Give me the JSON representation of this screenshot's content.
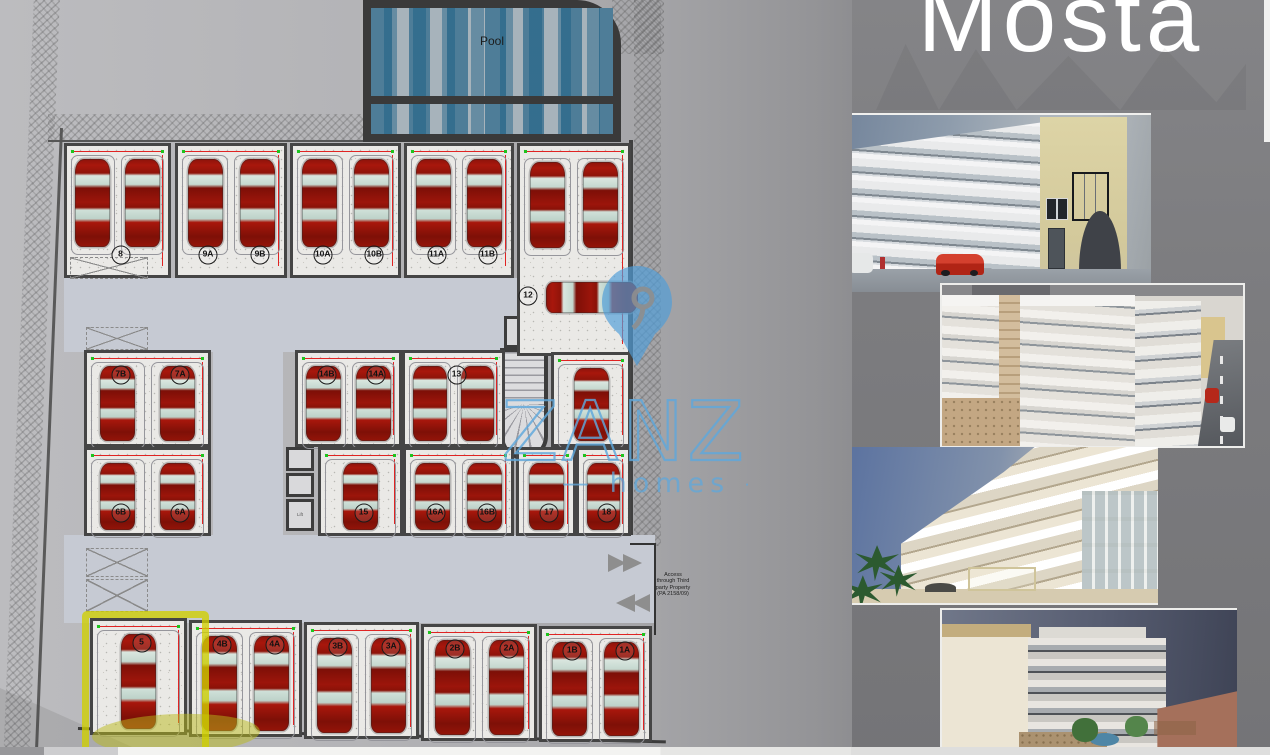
{
  "project": {
    "title": "Mosta"
  },
  "watermark": {
    "brand": "ZANZI",
    "tagline": "— homes —",
    "pin_color": "#4f9dd9",
    "text_color": "#5fa8dc"
  },
  "floor_plan": {
    "pool_label": "Pool",
    "lift_label": "Lift",
    "access_note": "Access through Third party Property (PA 2158/09)",
    "colors": {
      "driveway": "#c6cad3",
      "bay_floor": "#eae9e6",
      "wall": "#454545",
      "car_body": "#9c150b",
      "car_glass": "#cfe0d8",
      "dimension_line": "#e02322",
      "dimension_tick": "#1ec41e",
      "highlight": "#d0d000"
    },
    "bays": [
      {
        "x": 64,
        "y": 143,
        "w": 107,
        "h": 135,
        "cars": 2,
        "labels": [
          "8"
        ],
        "labelAt": "bottom"
      },
      {
        "x": 175,
        "y": 143,
        "w": 112,
        "h": 135,
        "cars": 2,
        "labels": [
          "9A",
          "9B"
        ],
        "labelAt": "bottom"
      },
      {
        "x": 290,
        "y": 143,
        "w": 111,
        "h": 135,
        "cars": 2,
        "labels": [
          "10A",
          "10B"
        ],
        "labelAt": "bottom"
      },
      {
        "x": 404,
        "y": 143,
        "w": 110,
        "h": 135,
        "cars": 2,
        "labels": [
          "11A",
          "11B"
        ],
        "labelAt": "bottom"
      },
      {
        "x": 517,
        "y": 143,
        "w": 114,
        "h": 213,
        "cars": 2,
        "labels": [],
        "labelAt": "bottom",
        "carH": 86,
        "carTop": 16
      },
      {
        "x": 84,
        "y": 350,
        "w": 127,
        "h": 97,
        "cars": 2,
        "labels": [
          "7B",
          "7A"
        ],
        "labelAt": "top"
      },
      {
        "x": 295,
        "y": 350,
        "w": 107,
        "h": 97,
        "cars": 2,
        "labels": [
          "14B",
          "14A"
        ],
        "labelAt": "top"
      },
      {
        "x": 402,
        "y": 350,
        "w": 103,
        "h": 97,
        "cars": 2,
        "labels": [
          "13"
        ],
        "labelAt": "top"
      },
      {
        "x": 551,
        "y": 352,
        "w": 80,
        "h": 95,
        "cars": 1,
        "labels": [],
        "labelAt": "top"
      },
      {
        "x": 84,
        "y": 447,
        "w": 127,
        "h": 89,
        "cars": 2,
        "labels": [
          "6B",
          "6A"
        ],
        "labelAt": "bottom"
      },
      {
        "x": 318,
        "y": 447,
        "w": 85,
        "h": 89,
        "cars": 1,
        "labels": [
          "15"
        ],
        "labelAt": "bottom"
      },
      {
        "x": 403,
        "y": 447,
        "w": 111,
        "h": 89,
        "cars": 2,
        "labels": [
          "16A",
          "16B"
        ],
        "labelAt": "bottom"
      },
      {
        "x": 516,
        "y": 447,
        "w": 60,
        "h": 89,
        "cars": 1,
        "labels": [
          "17"
        ],
        "labelAt": "bottom"
      },
      {
        "x": 576,
        "y": 447,
        "w": 55,
        "h": 89,
        "cars": 1,
        "labels": [
          "18"
        ],
        "labelAt": "bottom"
      },
      {
        "x": 90,
        "y": 618,
        "w": 97,
        "h": 117,
        "cars": 1,
        "labels": [
          "5"
        ],
        "labelAt": "top",
        "highlight": true
      },
      {
        "x": 189,
        "y": 620,
        "w": 113,
        "h": 117,
        "cars": 2,
        "labels": [
          "4B",
          "4A"
        ],
        "labelAt": "top"
      },
      {
        "x": 304,
        "y": 622,
        "w": 115,
        "h": 117,
        "cars": 2,
        "labels": [
          "3B",
          "3A"
        ],
        "labelAt": "top"
      },
      {
        "x": 421,
        "y": 624,
        "w": 116,
        "h": 117,
        "cars": 2,
        "labels": [
          "2B",
          "2A"
        ],
        "labelAt": "top"
      },
      {
        "x": 539,
        "y": 626,
        "w": 113,
        "h": 116,
        "cars": 2,
        "labels": [
          "1B",
          "1A"
        ],
        "labelAt": "top"
      }
    ],
    "extra_cars": [
      {
        "x": 546,
        "y": 282,
        "w": 92,
        "h": 31
      }
    ],
    "extra_labels": [
      {
        "text": "12",
        "x": 528,
        "y": 296
      }
    ],
    "crossed_boxes": [
      {
        "x": 70,
        "y": 257,
        "w": 78,
        "h": 22
      },
      {
        "x": 86,
        "y": 327,
        "w": 62,
        "h": 23
      },
      {
        "x": 86,
        "y": 548,
        "w": 62,
        "h": 29
      },
      {
        "x": 86,
        "y": 579,
        "w": 62,
        "h": 33
      }
    ]
  },
  "photos": [
    {
      "id": "street-facade-render"
    },
    {
      "id": "corner-aerial-render"
    },
    {
      "id": "rear-balconies-render"
    },
    {
      "id": "back-pool-dusk-render"
    }
  ]
}
